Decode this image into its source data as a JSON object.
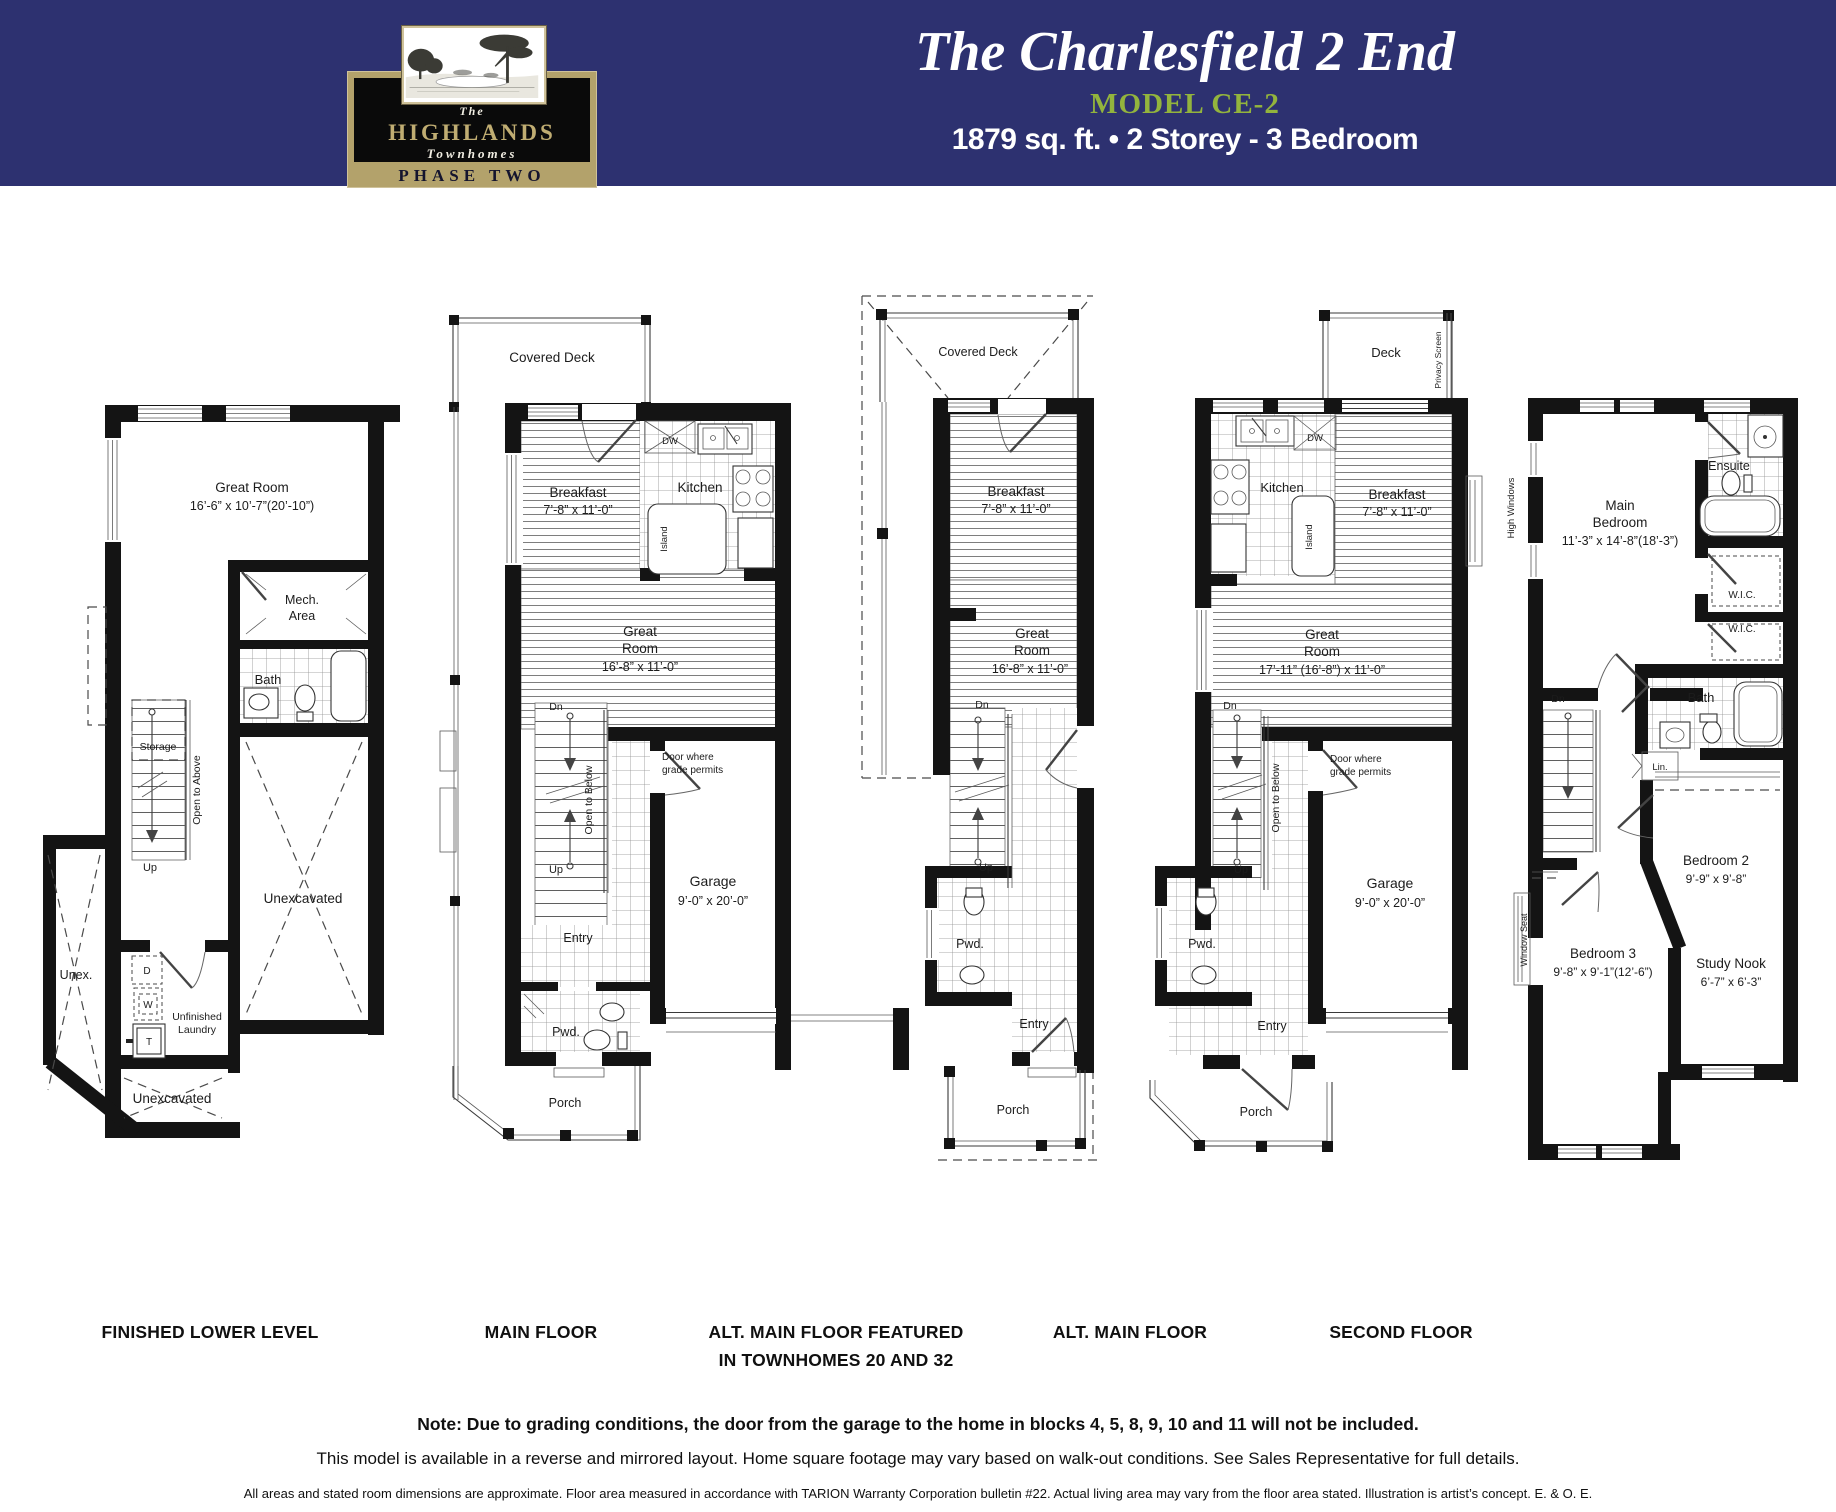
{
  "header": {
    "logo": {
      "the": "The",
      "name": "HIGHLANDS",
      "townhomes": "Townhomes",
      "phase": "PHASE TWO"
    },
    "title": "The Charlesfield 2 End",
    "model": "MODEL CE-2",
    "specs": "1879 sq. ft. • 2 Storey - 3 Bedroom"
  },
  "colors": {
    "navy": "#2d3170",
    "gold": "#b3a26b",
    "green": "#93b43d"
  },
  "plans": [
    {
      "label": "FINISHED LOWER LEVEL",
      "texts": {
        "great_room": "Great Room",
        "great_room_dim": "16’-6” x 10’-7”(20’-10”)",
        "mech_1": "Mech.",
        "mech_2": "Area",
        "bath": "Bath",
        "storage": "Storage",
        "open_to_above": "Open to Above",
        "up": "Up",
        "unex": "Unex.",
        "dryer": "D",
        "washer": "W",
        "tank": "T",
        "laundry_1": "Unfinished",
        "laundry_2": "Laundry",
        "unexcavated_side": "Unexcavated",
        "unexcavated_bottom": "Unexcavated"
      }
    },
    {
      "label": "MAIN FLOOR",
      "texts": {
        "covered_deck": "Covered Deck",
        "breakfast": "Breakfast",
        "breakfast_dim": "7’-8” x 11’-0”",
        "kitchen": "Kitchen",
        "dw": "DW",
        "island": "Island",
        "great_1": "Great",
        "great_2": "Room",
        "great_dim": "16’-8” x 11’-0”",
        "dn": "Dn",
        "open_to_below": "Open to Below",
        "door_grade_1": "Door where",
        "door_grade_2": "grade permits",
        "up": "Up",
        "garage": "Garage",
        "garage_dim": "9’-0” x 20’-0”",
        "entry": "Entry",
        "pwd": "Pwd.",
        "porch": "Porch"
      }
    },
    {
      "label_1": "ALT. MAIN FLOOR FEATURED",
      "label_2": "IN TOWNHOMES 20 AND 32",
      "texts": {
        "covered_deck": "Covered Deck",
        "breakfast": "Breakfast",
        "breakfast_dim": "7’-8” x 11’-0”",
        "great_1": "Great",
        "great_2": "Room",
        "great_dim": "16’-8” x 11’-0”",
        "dn": "Dn",
        "up": "Up",
        "pwd": "Pwd.",
        "entry": "Entry",
        "porch": "Porch"
      }
    },
    {
      "label": "ALT. MAIN FLOOR",
      "texts": {
        "deck": "Deck",
        "privacy": "Privacy Screen",
        "kitchen": "Kitchen",
        "dw": "DW",
        "island": "Island",
        "breakfast": "Breakfast",
        "breakfast_dim": "7’-8” x 11’-0”",
        "great_1": "Great",
        "great_2": "Room",
        "great_dim": "17’-11” (16’-8”) x 11’-0”",
        "dn": "Dn",
        "open_to_below": "Open to Below",
        "door_grade_1": "Door where",
        "door_grade_2": "grade permits",
        "up": "Up",
        "garage": "Garage",
        "garage_dim": "9’-0” x 20’-0”",
        "pwd": "Pwd.",
        "entry": "Entry",
        "porch": "Porch"
      }
    },
    {
      "label": "SECOND FLOOR",
      "texts": {
        "high_windows": "High Windows",
        "ensuite": "Ensuite",
        "main_1": "Main",
        "main_2": "Bedroom",
        "main_dim": "11’-3” x 14’-8”(18’-3”)",
        "wic_a": "W.I.C.",
        "wic_b": "W.I.C.",
        "bath": "Bath",
        "dn": "Dn",
        "lin": "Lin.",
        "bed2": "Bedroom 2",
        "bed2_dim": "9’-9” x 9’-8”",
        "window_seat": "Window Seat",
        "bed3": "Bedroom 3",
        "bed3_dim": "9’-8” x 9’-1”(12’-6”)",
        "study": "Study Nook",
        "study_dim": "6’-7” x 6’-3”"
      }
    }
  ],
  "footnotes": {
    "note_bold": "Note: Due to grading conditions, the door from the garage to the home in blocks 4, 5, 8, 9, 10 and 11 will not be included.",
    "note_regular": "This model is available in a reverse and mirrored layout. Home square footage may vary based on walk-out conditions. See Sales Representative for full details.",
    "note_small": "All areas and stated room dimensions are approximate. Floor area measured in accordance with TARION Warranty Corporation bulletin #22. Actual living area may vary from the floor area stated. Illustration is artist’s concept. E. & O. E."
  }
}
